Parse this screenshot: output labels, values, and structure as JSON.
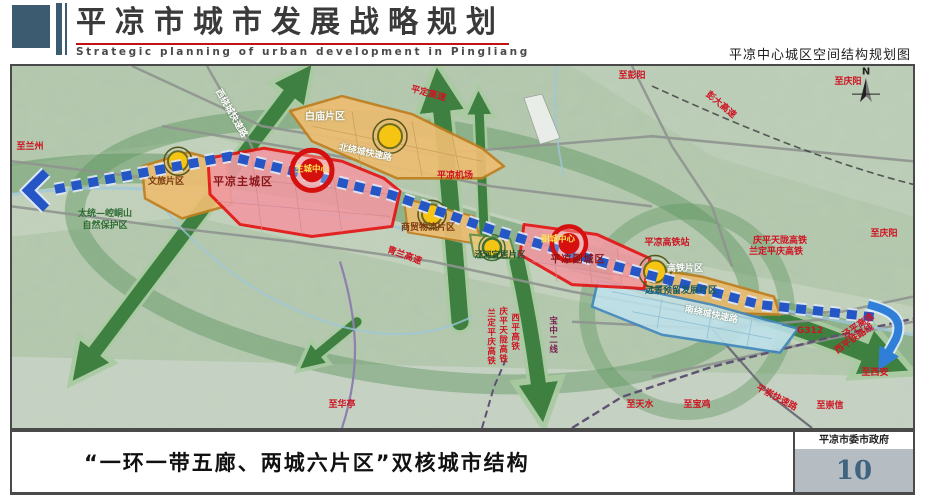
{
  "header": {
    "title_cn": "平凉市城市发展战略规划",
    "title_en": "Strategic planning of urban development in Pingliang",
    "map_title": "平凉中心城区空间结构规划图"
  },
  "footer": {
    "caption": "“一环一带五廊、两城六片区”双核城市结构",
    "government": "平凉市委市政府",
    "page_number": "10"
  },
  "map": {
    "colors": {
      "terrain_green": "#b6cab0",
      "corridor_green": "#367a39",
      "axis_blue": "#2457c5",
      "city_zone_fill": "#f09aa2",
      "city_zone_border": "#e51212",
      "district_fill": "#edbd72",
      "district_border": "#c07f1f",
      "reserved_fill": "#bfe2ec",
      "reserved_border": "#3f87bf",
      "node_yellow": "#f6c413",
      "label_red": "#cf1322"
    },
    "labels": {
      "to_lanzhou": "至兰州",
      "west_ring_expwy": "西绕城快速路",
      "baimiao_district": "白庙片区",
      "pingding_expwy": "平定高速",
      "to_pengyang": "至彭阳",
      "pengda_expwy": "彭大高速",
      "to_qingyang_top": "至庆阳",
      "north_ring_expwy": "北绕城快速路",
      "main_city": "平凉主城区",
      "main_city_center": "主城中心",
      "nature_reserve_line1": "太统—崆峒山",
      "nature_reserve_line2": "自然保护区",
      "wenlv_district": "文旅片区",
      "airport": "平凉机场",
      "qinglan_expwy": "青兰高速",
      "trade_logistics_district": "商贸物流片区",
      "jinghe_livable_district": "泾河宜居片区",
      "sub_city": "平凉副城区",
      "sub_city_center": "副城中心",
      "hsr_station": "平凉高铁站",
      "hsr_district": "高铁片区",
      "reserved_district": "远景预留发展片区",
      "south_ring_expwy": "南绕城快速路",
      "qingping_tianlong_hsr": "庆平天陇高铁",
      "landing_pingqing_hsr": "兰定平庆高铁",
      "to_qingyang_right": "至庆阳",
      "g312": "G312",
      "jingping_expwy": "泾平高速",
      "xiping_railway": "西平铁路线",
      "to_xian": "至西安",
      "to_huating": "至华亭",
      "v_landing_pingqing": "兰定平庆高铁",
      "v_qingping_tianlong": "庆平天陇高铁",
      "v_xiping_hsr": "西平高铁",
      "v_baozhong_line": "宝中二线",
      "to_tianshui": "至天水",
      "to_baoji": "至宝鸡",
      "pingchong_expwy": "平崇快速路",
      "to_chongxin": "至崇信",
      "compass_n": "N"
    }
  }
}
